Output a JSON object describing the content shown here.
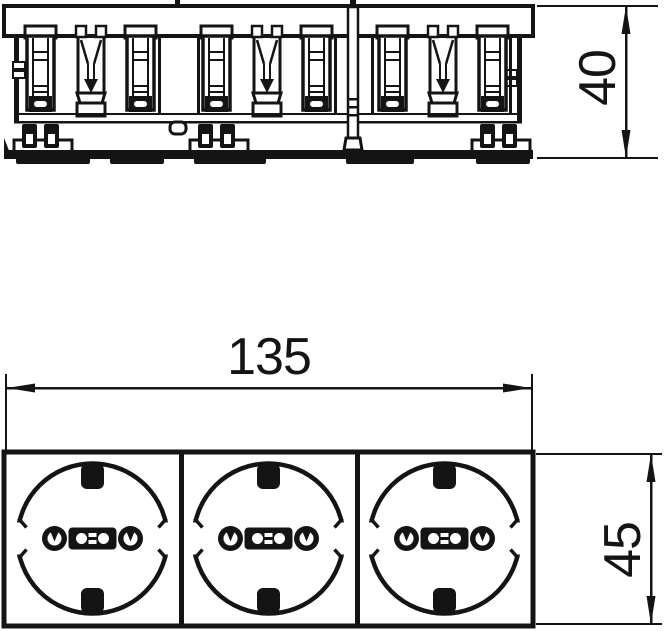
{
  "page": {
    "background": "#ffffff",
    "line_color": "#141414",
    "kind": "technical dimension drawing"
  },
  "views": {
    "side": {
      "name": "side profile section view",
      "module_count": 3
    },
    "front": {
      "name": "front view",
      "socket_count": 3,
      "socket_type": "schuko-outlet"
    }
  },
  "dimensions": {
    "depth": {
      "label": "40",
      "orientation": "vertical",
      "location": "right of side view"
    },
    "width": {
      "label": "135",
      "orientation": "horizontal",
      "location": "above front view"
    },
    "height": {
      "label": "45",
      "orientation": "vertical",
      "location": "right of front view"
    }
  }
}
